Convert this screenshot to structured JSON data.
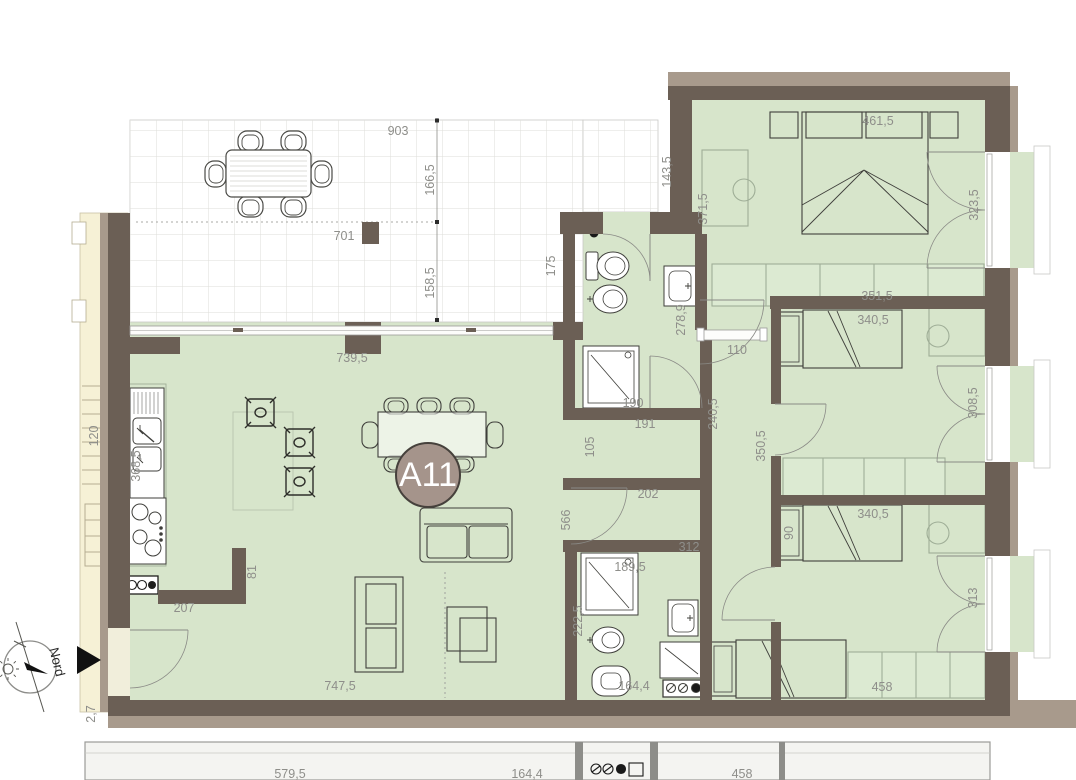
{
  "badge": {
    "label": "A11"
  },
  "compass": {
    "label": "Nord"
  },
  "colors": {
    "room_green": "#d7e5cb",
    "wall_dark": "#6b5f55",
    "wall_light": "#a89a8c",
    "stair_cream": "#f6f1d6",
    "dim_text": "#8e8e8a",
    "badge_fill": "#a5948b"
  },
  "dimensions": [
    {
      "id": "terrace-width",
      "t": "903",
      "x": 398,
      "y": 131,
      "r": 0
    },
    {
      "id": "terrace-depth-upper",
      "t": "166,5",
      "x": 430,
      "y": 180,
      "r": -90
    },
    {
      "id": "terrace-depth-lower",
      "t": "158,5",
      "x": 430,
      "y": 283,
      "r": -90
    },
    {
      "id": "terrace-post",
      "t": "701",
      "x": 344,
      "y": 236,
      "r": 0
    },
    {
      "id": "living-window-width",
      "t": "739,5",
      "x": 352,
      "y": 358,
      "r": 0
    },
    {
      "id": "terrace-edge-175",
      "t": "175",
      "x": 551,
      "y": 266,
      "r": -90
    },
    {
      "id": "terrace-edge-143",
      "t": "143,5",
      "x": 667,
      "y": 172,
      "r": -90
    },
    {
      "id": "stair-width",
      "t": "120",
      "x": 94,
      "y": 436,
      "r": -90
    },
    {
      "id": "kitchen-counter",
      "t": "368,5",
      "x": 136,
      "y": 466,
      "r": -90
    },
    {
      "id": "kitchen-wall",
      "t": "207",
      "x": 184,
      "y": 608,
      "r": 0
    },
    {
      "id": "kitchen-return",
      "t": "81",
      "x": 252,
      "y": 572,
      "r": -90
    },
    {
      "id": "living-width",
      "t": "747,5",
      "x": 340,
      "y": 686,
      "r": 0
    },
    {
      "id": "living-hall-wall",
      "t": "566",
      "x": 566,
      "y": 520,
      "r": -90
    },
    {
      "id": "master-bed-width",
      "t": "461,5",
      "x": 878,
      "y": 121,
      "r": 0
    },
    {
      "id": "master-depth",
      "t": "371,5",
      "x": 703,
      "y": 209,
      "r": -90
    },
    {
      "id": "master-door",
      "t": "323,5",
      "x": 974,
      "y": 205,
      "r": -90
    },
    {
      "id": "master-wardrobe",
      "t": "351,5",
      "x": 877,
      "y": 296,
      "r": 0
    },
    {
      "id": "bed2-width",
      "t": "340,5",
      "x": 873,
      "y": 320,
      "r": 0
    },
    {
      "id": "bed2-door",
      "t": "308,5",
      "x": 973,
      "y": 403,
      "r": -90
    },
    {
      "id": "hall-length",
      "t": "350,5",
      "x": 761,
      "y": 446,
      "r": -90
    },
    {
      "id": "hall-opening",
      "t": "110",
      "x": 737,
      "y": 350,
      "r": 0
    },
    {
      "id": "hall-wall",
      "t": "240,5",
      "x": 713,
      "y": 414,
      "r": -90
    },
    {
      "id": "bath1-depth",
      "t": "278,9",
      "x": 681,
      "y": 320,
      "r": -90
    },
    {
      "id": "bath1-width",
      "t": "190",
      "x": 633,
      "y": 403,
      "r": 0
    },
    {
      "id": "store-width",
      "t": "191",
      "x": 645,
      "y": 424,
      "r": 0
    },
    {
      "id": "store-depth",
      "t": "105",
      "x": 590,
      "y": 447,
      "r": -90
    },
    {
      "id": "store-opening",
      "t": "202",
      "x": 648,
      "y": 494,
      "r": 0
    },
    {
      "id": "hall-lower",
      "t": "312",
      "x": 689,
      "y": 547,
      "r": 0
    },
    {
      "id": "bath2-shower",
      "t": "189,5",
      "x": 630,
      "y": 567,
      "r": 0
    },
    {
      "id": "bath2-depth",
      "t": "222,5",
      "x": 578,
      "y": 621,
      "r": -90
    },
    {
      "id": "bath2-width",
      "t": "164,4",
      "x": 634,
      "y": 686,
      "r": 0
    },
    {
      "id": "bed3-width",
      "t": "340,5",
      "x": 873,
      "y": 514,
      "r": 0
    },
    {
      "id": "bed3-wardrobe",
      "t": "90",
      "x": 789,
      "y": 533,
      "r": -90
    },
    {
      "id": "bed3-bedwall",
      "t": "458",
      "x": 882,
      "y": 687,
      "r": 0
    },
    {
      "id": "bed3-door",
      "t": "313",
      "x": 973,
      "y": 598,
      "r": -90
    },
    {
      "id": "strip-579",
      "t": "579,5",
      "x": 290,
      "y": 774,
      "r": 0
    },
    {
      "id": "strip-164",
      "t": "164,4",
      "x": 527,
      "y": 774,
      "r": 0
    },
    {
      "id": "strip-458",
      "t": "458",
      "x": 742,
      "y": 774,
      "r": 0
    },
    {
      "id": "strip-27",
      "t": "2,7",
      "x": 91,
      "y": 714,
      "r": -90
    }
  ]
}
